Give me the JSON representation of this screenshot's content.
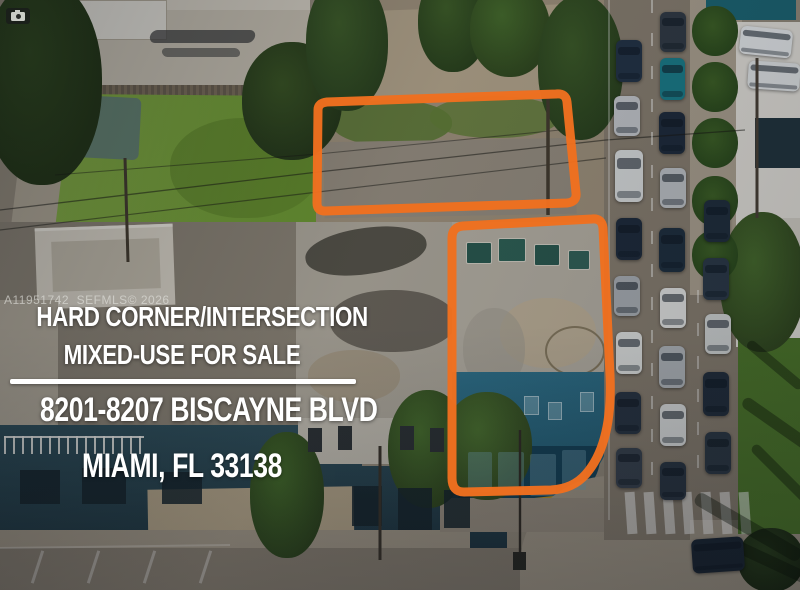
{
  "watermark": {
    "id_text": "A11951742  SEFMLS© 2026",
    "camera_icon": "camera-icon"
  },
  "headline": {
    "line1": "HARD CORNER/INTERSECTION",
    "line2": "MIXED-USE FOR SALE",
    "line3": "8201-8207 BISCAYNE BLVD",
    "line4": "MIAMI, FL 33138"
  },
  "colors": {
    "outline_orange": "#f0701f",
    "headline_text": "#ffffff",
    "divider": "#ffffff"
  }
}
